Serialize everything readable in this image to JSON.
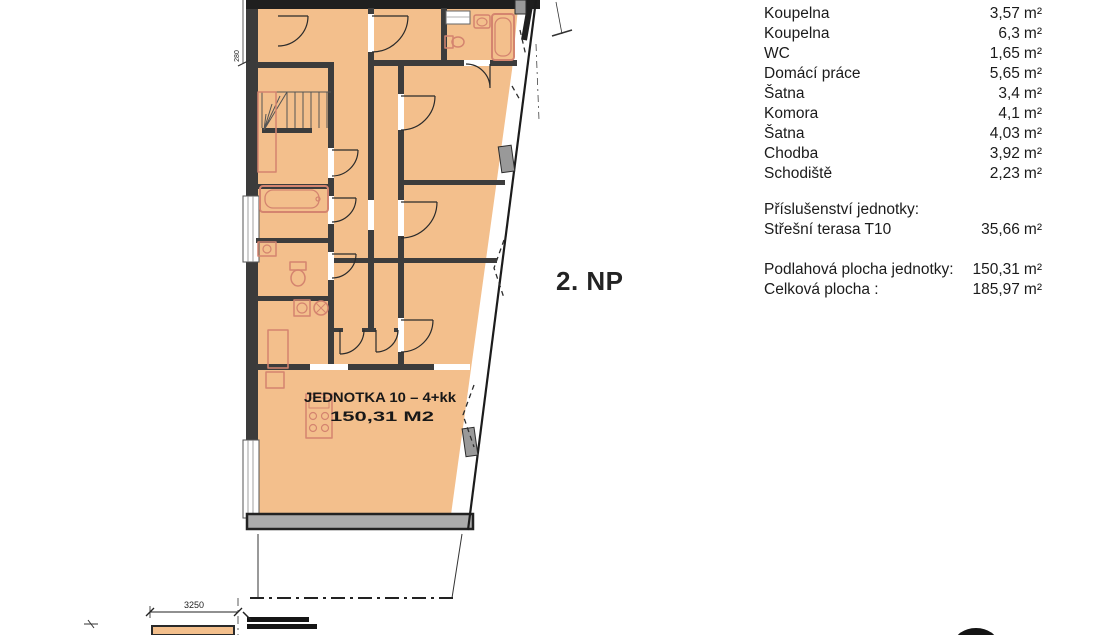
{
  "floor_label": "2. NP",
  "plan": {
    "unit_title": "JEDNOTKA 10 – 4+kk",
    "unit_area": "150,31 M2"
  },
  "room_list": {
    "unit_suffix": "m²",
    "rows": [
      {
        "name": "Koupelna",
        "area": "3,57"
      },
      {
        "name": "Koupelna",
        "area": "6,3"
      },
      {
        "name": "WC",
        "area": "1,65"
      },
      {
        "name": "Domácí práce",
        "area": "5,65"
      },
      {
        "name": "Šatna",
        "area": "3,4"
      },
      {
        "name": "Komora",
        "area": "4,1"
      },
      {
        "name": "Šatna",
        "area": "4,03"
      },
      {
        "name": "Chodba",
        "area": "3,92"
      },
      {
        "name": "Schodiště",
        "area": "2,23"
      }
    ]
  },
  "accessories": {
    "title": "Příslušenství jednotky:",
    "rows": [
      {
        "name": "Střešní terasa T10",
        "area": "35,66"
      }
    ]
  },
  "totals": {
    "rows": [
      {
        "name": "Podlahová plocha jednotky:",
        "area": "150,31"
      },
      {
        "name": "Celková plocha :",
        "area": "185,97"
      }
    ]
  },
  "dimensions": {
    "left_height": "280",
    "bottom_width": "3250"
  },
  "colors": {
    "room_fill": "#f3bf8c",
    "fixture": "#d4846f",
    "wall_dark": "#3c3c3c",
    "outline": "#1c1c1c"
  }
}
